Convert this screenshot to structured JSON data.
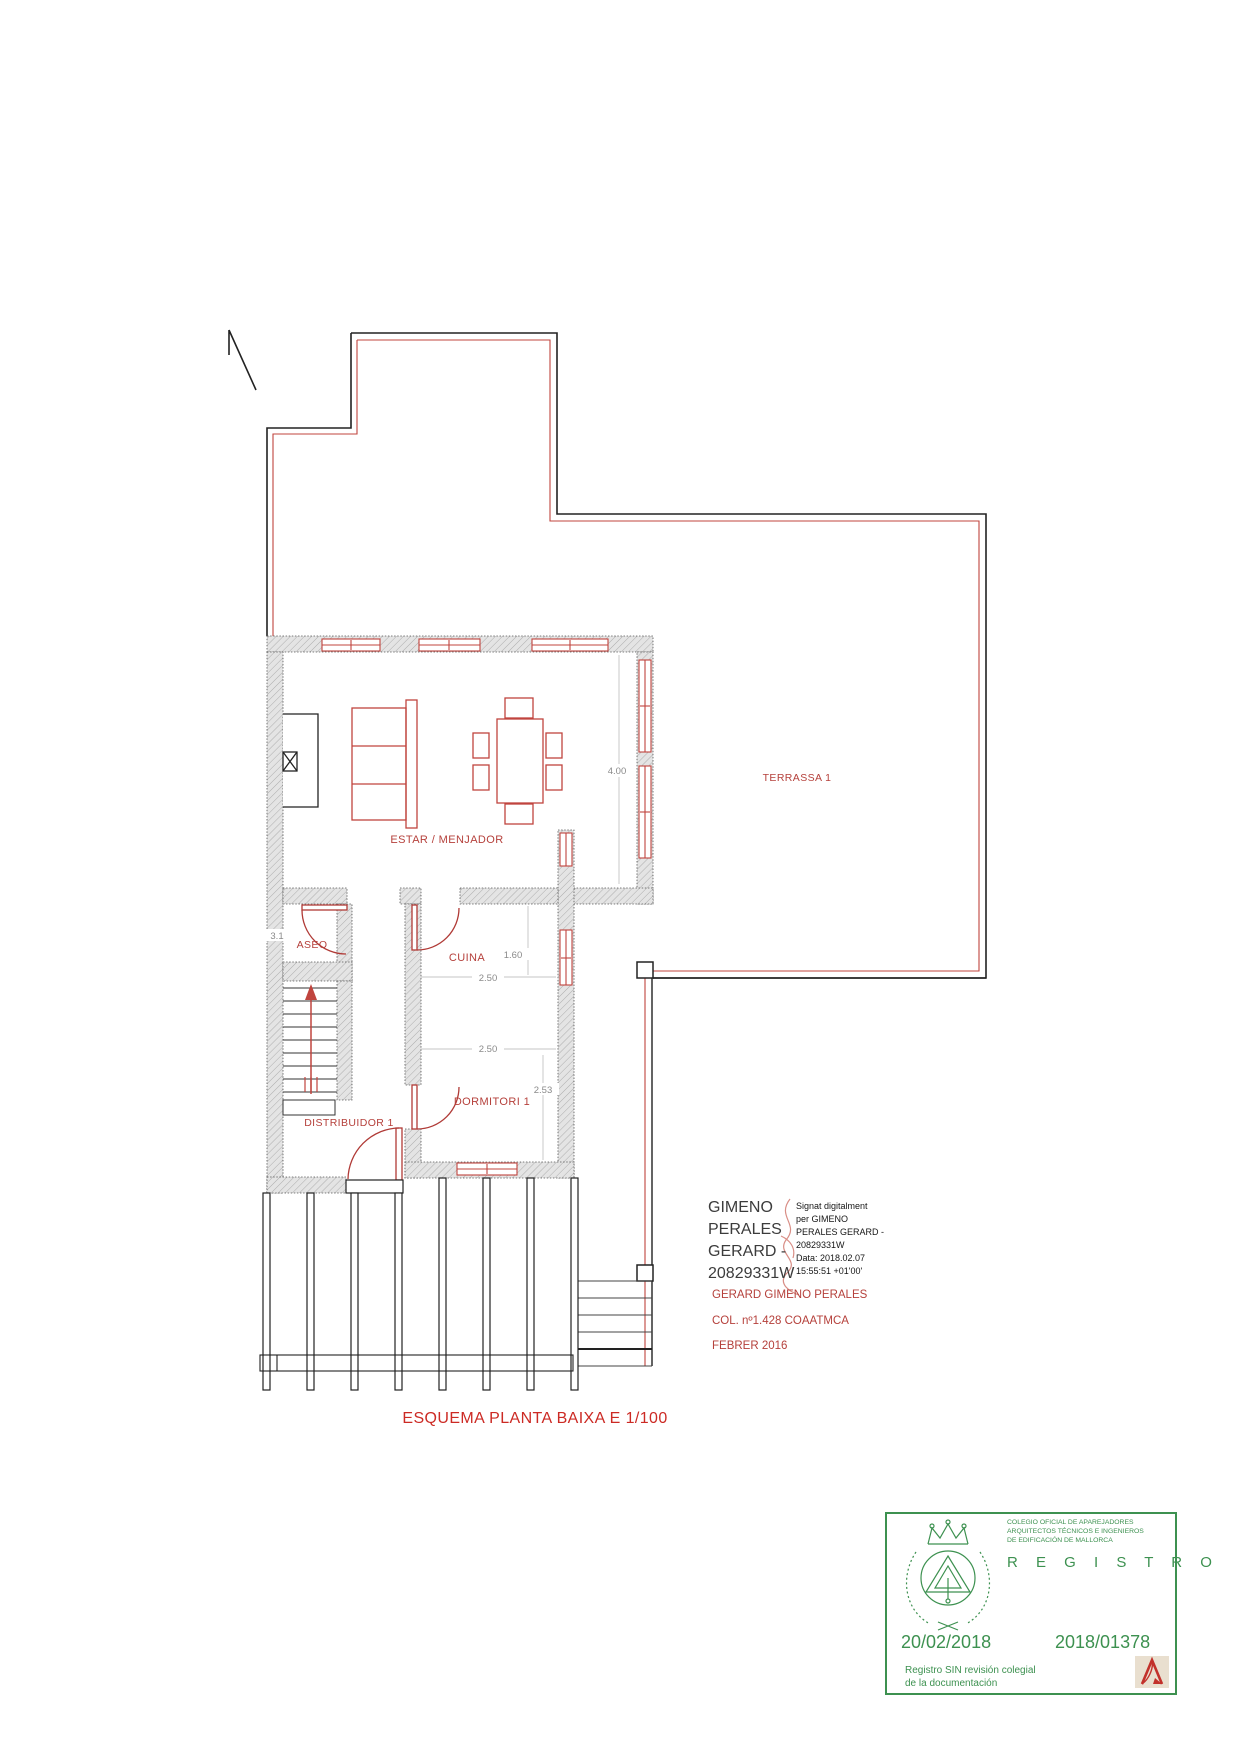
{
  "title": "ESQUEMA PLANTA BAIXA E 1/100",
  "plan": {
    "rooms": {
      "terrassa": "TERRASSA 1",
      "estar": "ESTAR / MENJADOR",
      "aseo": "ASEO",
      "cuina": "CUINA",
      "dormitori": "DORMITORI 1",
      "distribuidor": "DISTRIBUIDOR 1"
    },
    "dims": {
      "living": "4.00",
      "cuina_w": "1.60",
      "cuina_d": "2.50",
      "dorm_w": "2.50",
      "dorm_d": "2.53",
      "aseo_frag": "3.1"
    }
  },
  "signature": {
    "name_lines": [
      "GIMENO",
      "PERALES",
      "GERARD -",
      "20829331W"
    ],
    "detail_lines": [
      "Signat digitalment",
      "per GIMENO",
      "PERALES GERARD -",
      "20829331W",
      "Data: 2018.02.07",
      "15:55:51 +01'00'"
    ],
    "cert_lines": [
      "GERARD GIMENO PERALES",
      "COL. nº1.428 COAATMCA",
      "FEBRER 2016"
    ]
  },
  "stamp": {
    "org_lines": [
      "COLEGIO OFICIAL DE APAREJADORES",
      "ARQUITECTOS TÉCNICOS E INGENIEROS",
      "DE EDIFICACIÓN DE MALLORCA"
    ],
    "registro": "R E G I S T R O",
    "date": "20/02/2018",
    "number": "2018/01378",
    "note_lines": [
      "Registro SIN revisión colegial",
      "de la documentación"
    ]
  },
  "colors": {
    "plan_red": "#c0443e",
    "text_red": "#b5403b",
    "title_red": "#cc2a24",
    "stamp_green": "#3d9150",
    "logo_red": "#c2312b",
    "wall_gray": "#e4e4e4"
  }
}
